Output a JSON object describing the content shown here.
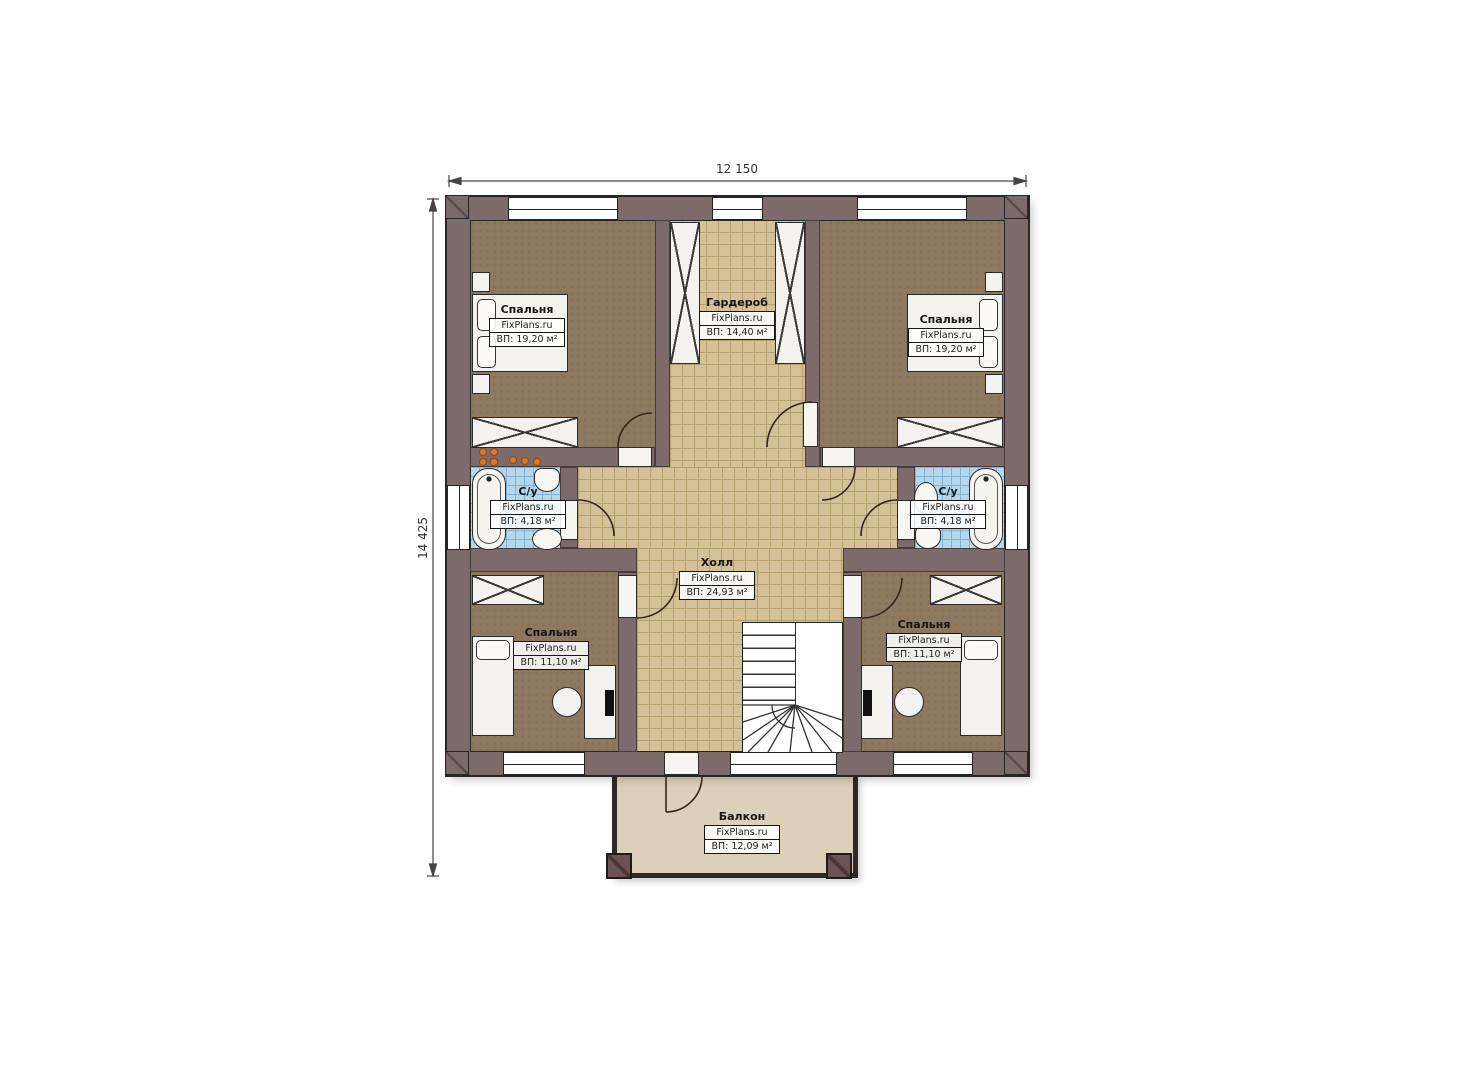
{
  "plan": {
    "type": "floor-plan",
    "brand": "FixPlans.ru",
    "dimensions": {
      "width_label": "12 150",
      "height_label": "14 425"
    },
    "rooms": {
      "bedroom_top_left": {
        "name": "Спальня",
        "brand": "FixPlans.ru",
        "area": "ВП: 19,20 м²"
      },
      "wardrobe": {
        "name": "Гардероб",
        "brand": "FixPlans.ru",
        "area": "ВП: 14,40 м²"
      },
      "bedroom_top_right": {
        "name": "Спальня",
        "brand": "FixPlans.ru",
        "area": "ВП: 19,20 м²"
      },
      "bathroom_left": {
        "name": "С/у",
        "brand": "FixPlans.ru",
        "area": "ВП: 4,18 м²"
      },
      "bathroom_right": {
        "name": "С/у",
        "brand": "FixPlans.ru",
        "area": "ВП: 4,18 м²"
      },
      "hall": {
        "name": "Холл",
        "brand": "FixPlans.ru",
        "area": "ВП: 24,93 м²"
      },
      "bedroom_bottom_left": {
        "name": "Спальня",
        "brand": "FixPlans.ru",
        "area": "ВП: 11,10 м²"
      },
      "bedroom_bottom_right": {
        "name": "Спальня",
        "brand": "FixPlans.ru",
        "area": "ВП: 11,10 м²"
      },
      "balcony": {
        "name": "Балкон",
        "brand": "FixPlans.ru",
        "area": "ВП: 12,09 м²"
      }
    },
    "colors": {
      "wall": "#7d6b6b",
      "floor_bedroom": "#8c7960",
      "floor_tile": "#d5c198",
      "floor_bathroom": "#b4d7ec",
      "floor_balcony": "#dcd0bb",
      "furniture": "#f4f2ee",
      "accent_dots": "#e0762a"
    }
  }
}
